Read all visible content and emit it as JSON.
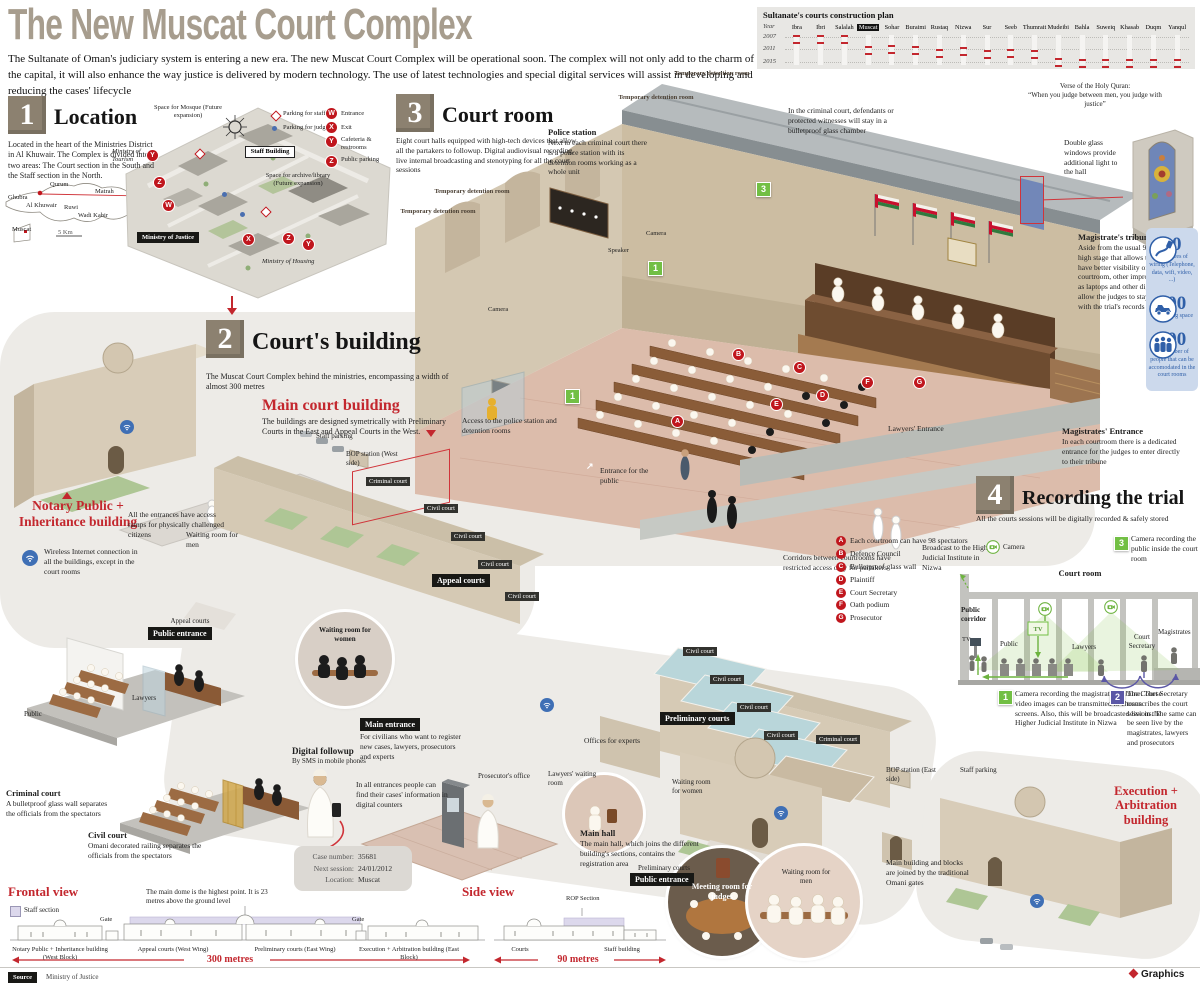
{
  "header": {
    "title": "The New Muscat Court Complex",
    "intro": "The Sultanate of Oman's judiciary system is entering a new era. The new Muscat Court Complex will be operational soon. The complex will not only add to the charm of the capital, it will also enhance the way justice is delivered by modern technology. The use of latest technologies and special digital services will assist in developing and reducing the cases' lifecycle"
  },
  "timeline": {
    "title": "Sultanate's courts construction plan",
    "year_col": "Year",
    "years": [
      "2007",
      "2011",
      "2015"
    ],
    "cities": [
      {
        "name": "Ibra",
        "pos": 0.03
      },
      {
        "name": "Ibri",
        "pos": 0.03
      },
      {
        "name": "Salalah",
        "pos": 0.03
      },
      {
        "name": "Muscat",
        "pos": 0.46,
        "highlight": true
      },
      {
        "name": "Sohar",
        "pos": 0.4
      },
      {
        "name": "Buraimi",
        "pos": 0.46
      },
      {
        "name": "Rustaq",
        "pos": 0.56
      },
      {
        "name": "Nizwa",
        "pos": 0.5
      },
      {
        "name": "Sur",
        "pos": 0.62
      },
      {
        "name": "Seeb",
        "pos": 0.58
      },
      {
        "name": "Thumrait",
        "pos": 0.62
      },
      {
        "name": "Mudeibi",
        "pos": 0.94
      },
      {
        "name": "Bahla",
        "pos": 0.97
      },
      {
        "name": "Suweiq",
        "pos": 0.97
      },
      {
        "name": "Khasab",
        "pos": 0.97
      },
      {
        "name": "Duqm",
        "pos": 0.97
      },
      {
        "name": "Yanqul",
        "pos": 0.97
      }
    ]
  },
  "chart_data": {
    "type": "scatter",
    "title": "Sultanate's courts construction plan",
    "ylabel": "Year",
    "yticks": [
      2007,
      2011,
      2015
    ],
    "categories": [
      "Ibra",
      "Ibri",
      "Salalah",
      "Muscat",
      "Sohar",
      "Buraimi",
      "Rustaq",
      "Nizwa",
      "Sur",
      "Seeb",
      "Thumrait",
      "Mudeibi",
      "Bahla",
      "Suweiq",
      "Khasab",
      "Duqm",
      "Yanqul"
    ],
    "values": [
      2007,
      2007,
      2007,
      2010,
      2010,
      2010,
      2011,
      2011,
      2012,
      2012,
      2012,
      2015,
      2015,
      2015,
      2015,
      2015,
      2015
    ],
    "highlight": "Muscat"
  },
  "sec1": {
    "num": "1",
    "heading": "Location",
    "body": "Located in the heart of the Ministries District in Al Khuwair. The Complex is divided into two areas: The Court section in the South and the Staff section in the North.",
    "sketch": {
      "cities": [
        "Qurum",
        "Matrah",
        "Ghubra",
        "Al Khuwair",
        "Ruwi",
        "Wadi Kabir",
        "Muscat"
      ],
      "scale": "5 Km"
    },
    "legend": {
      "staff_parking": "Parking for staff",
      "judges_parking": "Parking for judges",
      "w": "Entrance",
      "x": "Exit",
      "y": "Cafeteria & restrooms",
      "z": "Public parking"
    },
    "markers": {
      "w": "W",
      "x": "X",
      "y": "Y",
      "z": "Z"
    },
    "map": {
      "mosque": "Space for Mosque (Future expansion)",
      "archive": "Space for archive/library (Future expansion)",
      "tourism": "Ministry of Tourism",
      "justice": "Ministry of Justice",
      "housing": "Ministry of Housing",
      "staff_building": "Staff Building"
    }
  },
  "sec3": {
    "num": "3",
    "heading": "Court room",
    "body": "Eight court halls equipped with high-tech devices that allow all the partakers to followup. Digital audiovisual recording, live internal broadcasting and stenotyping for all the court sessions",
    "police_title": "Police station",
    "police_body": "Next to each criminal court there is a police station with its detention rooms working as a whole unit",
    "temp_room": "Temporary detention room",
    "glass_chamber": "In the criminal court, defendants or protected witnesses will stay in a bulletproof glass chamber",
    "camera": "Camera",
    "speaker": "Speaker",
    "verse_title": "Verse of the Holy Quran:",
    "verse_quote": "“When you judge between men, you judge with justice”",
    "access": "Access to the police station and detention rooms",
    "entrance_public": "Entrance for the public",
    "lawyers_entrance": "Lawyers' Entrance",
    "magistrates_entrance_title": "Magistrates' Entrance",
    "magistrates_entrance_body": "In each courtroom there is a dedicated entrance for the judges to enter directly to their tribune",
    "corridors": "Corridors between courtrooms have restricted access only for partakers",
    "double_glass": "Double glass windows provide additional light to the hall",
    "tribune_title": "Magistrate's tribune",
    "tribune_body": "Aside from the usual 90 centimetre high stage that allows the judges to have better visibility of the whole courtroom, other improvements such as laptops and other digital media, allow the judges to stay up-to-date with the trial's records"
  },
  "stats": [
    {
      "value": "80",
      "label": "kilometres of wiring (Telephone, data, wifi, video, ...)",
      "icon": "cable-icon"
    },
    {
      "value": "400",
      "label": "car parking space",
      "icon": "car-icon"
    },
    {
      "value": "800",
      "label": "the number of people that can be accomodated in the court rooms",
      "icon": "people-icon"
    }
  ],
  "legend_letters": [
    {
      "k": "A",
      "t": "Each courtroom can have 98 spectators"
    },
    {
      "k": "B",
      "t": "Defence Council"
    },
    {
      "k": "C",
      "t": "Bulletproof glass wall"
    },
    {
      "k": "D",
      "t": "Plaintiff"
    },
    {
      "k": "E",
      "t": "Court Secretary"
    },
    {
      "k": "F",
      "t": "Oath podium"
    },
    {
      "k": "G",
      "t": "Prosecutor"
    }
  ],
  "sec2": {
    "num": "2",
    "heading": "Court's building",
    "body": "The Muscat Court Complex behind the ministries, encompassing a width of almost 300 metres",
    "main_title": "Main court building",
    "main_body": "The buildings are designed symetrically with Preliminary Courts in the East and Appeal Courts in the West.",
    "staff_parking": "Staff parking",
    "bop_west": "BOP station (West side)",
    "bop_east": "BOP station (East side)",
    "criminal_court": "Criminal court",
    "civil_court": "Civil court",
    "appeal_courts": "Appeal courts",
    "preliminary_courts": "Preliminary courts",
    "public_entrance": "Public entrance",
    "notary": "Notary Public + Inheritance building",
    "wireless": "Wireless Internet connection in all the buildings, except in the court rooms",
    "ramps": "All the entrances have access ramps for physically challenged citizens",
    "waiting_men": "Waiting room for men",
    "waiting_women": "Waiting room for women",
    "lawyers_waiting": "Lawyers' waiting room",
    "offices_experts": "Offices for experts",
    "prosecutors_office": "Prosecutor's office",
    "main_entrance": "Main entrance",
    "main_entrance_body": "For civilians who want to register new cases, lawyers, prosecutors and experts",
    "digital_title": "Digital followup",
    "digital_sub": "By SMS in mobile phones",
    "counters": "In all entrances people can find their cases' information in digital counters",
    "case": {
      "rows": [
        {
          "k": "Case number:",
          "v": "35681"
        },
        {
          "k": "Next session:",
          "v": "24/01/2012"
        },
        {
          "k": "Location:",
          "v": "Muscat"
        }
      ]
    },
    "main_hall_title": "Main hall",
    "main_hall_body": "The main hall, which joins the different building's sections, contains the registration area",
    "meeting_room": "Meeting room for judges",
    "omani_gates": "Main building and blocks are joined by the traditional Omani gates",
    "execution": "Execution + Arbitration building",
    "public_label": "Public",
    "lawyers_label": "Lawyers",
    "criminal_demo_title": "Criminal court",
    "criminal_demo_body": "A bulletproof glass wall separates the officials from the spectators",
    "civil_demo_title": "Civil court",
    "civil_demo_body": "Omani decorated railing separates the officials from the spectators"
  },
  "sec4": {
    "num": "4",
    "heading": "Recording the trial",
    "body": "All the courts sessions will be digitally recorded & safely stored",
    "camera": "Camera",
    "badge1": "1",
    "badge2": "2",
    "badge3": "3",
    "note3": "Camera recording the public inside the court room",
    "court_room": "Court room",
    "broadcast": "Broadcast to the Higher Judicial Institute in Nizwa",
    "public_corridor": "Public corridor",
    "tv": "TV",
    "public": "Public",
    "lawyers": "Lawyers",
    "court_secretary": "Court Secretary",
    "magistrates": "Magistrates",
    "note1": "Camera recording the magistrate's tribune. These video images can be transmitted to chosen screens. Also, this will be broadcasted live in the Higher Judicial Institute in Nizwa",
    "note2": "The Court Secretary transcribes the court sessions. The same can be seen live by the magistrates, lawyers and prosecutors"
  },
  "bottom": {
    "frontal_title": "Frontal view",
    "staff_section": "Staff section",
    "dome_note": "The main dome is the highest point. It is 23 metres above the ground level",
    "gate": "Gate",
    "blocks": [
      "Notary Public + Inheritance building (West Block)",
      "Appeal courts (West Wing)",
      "Preliminary courts (East Wing)",
      "Execution + Arbitration building (East Block)"
    ],
    "m300": "300 metres",
    "side_title": "Side view",
    "rop": "ROP Section",
    "courts": "Courts",
    "staff_building": "Staff building",
    "m90": "90 metres"
  },
  "footer": {
    "source_label": "Source",
    "source_value": "Ministry of Justice",
    "brand": "Graphics"
  },
  "icons": {
    "camera": "camera-icon",
    "wifi": "wifi-icon",
    "cable": "cable-icon",
    "car": "car-icon",
    "people": "people-icon",
    "compass": "compass-icon",
    "parking_staff": "diamond-icon",
    "parking_judges": "dot-icon"
  }
}
